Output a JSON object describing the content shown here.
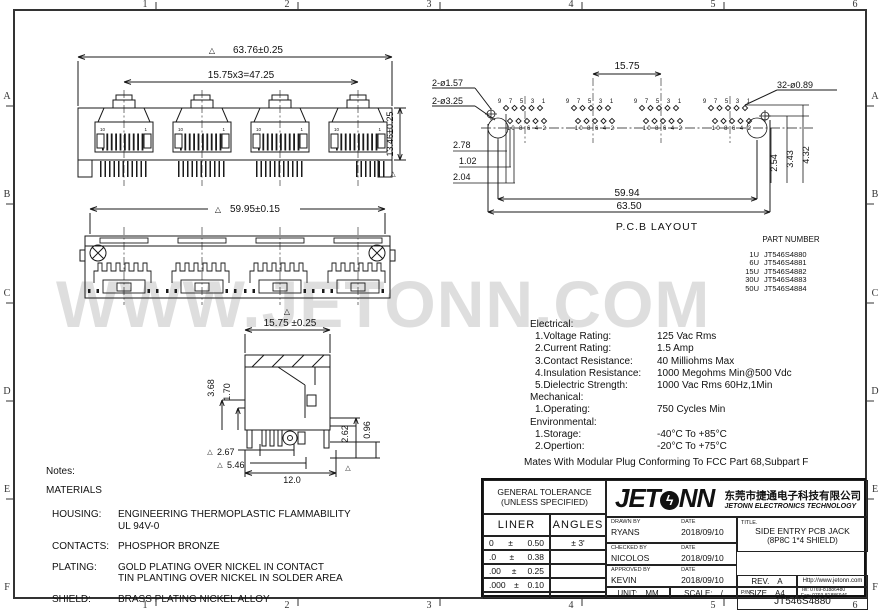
{
  "sheet": {
    "zone_cols": [
      "1",
      "2",
      "3",
      "4",
      "5",
      "6"
    ],
    "zone_rows": [
      "A",
      "B",
      "C",
      "D",
      "E",
      "F"
    ],
    "watermark": "WWW.JETONN.COM"
  },
  "icons": {
    "inspection_triangle": "△"
  },
  "views": {
    "front": {
      "dim_width": "63.76±0.25",
      "dim_pitch": "15.75x3=47.25",
      "dim_height": "13.46±0.25",
      "port_pin_left": "10",
      "port_pin_right": "1"
    },
    "rear": {
      "dim_width": "59.95±0.15"
    },
    "side": {
      "dim_width": "15.75 ±0.25",
      "dim_a": "3.68",
      "dim_b": "1.70",
      "dim_c": "2.67",
      "dim_d": "5.46",
      "dim_e": "12.0",
      "dim_f": "2.62",
      "dim_g": "0.96"
    },
    "pcb": {
      "label": "P.C.B LAYOUT",
      "dim_pitch": "15.75",
      "dim_hole_small": "2-ø1.57",
      "dim_hole_large": "2-ø3.25",
      "dim_pins": "32-ø0.89",
      "dim_a": "2.78",
      "dim_b": "1.02",
      "dim_c": "2.04",
      "dim_d": "2.54",
      "dim_e": "3.43",
      "dim_f": "4.32",
      "dim_span_inner": "59.94",
      "dim_span_outer": "63.50",
      "pin_numbers_top": "9 7 5 3 1",
      "pin_numbers_bottom": "10 8 6 4 2"
    }
  },
  "part_number": {
    "title": "PART NUMBER",
    "rows": [
      {
        "variant": "1U",
        "pn": "JT546S4880"
      },
      {
        "variant": "6U",
        "pn": "JT546S4881"
      },
      {
        "variant": "15U",
        "pn": "JT546S4882"
      },
      {
        "variant": "30U",
        "pn": "JT546S4883"
      },
      {
        "variant": "50U",
        "pn": "JT546S4884"
      }
    ]
  },
  "specs": {
    "sections": [
      {
        "header": "Electrical:",
        "items": [
          {
            "label": "1.Voltage Rating:",
            "value": "125 Vac Rms"
          },
          {
            "label": "2.Current Rating:",
            "value": "1.5 Amp"
          },
          {
            "label": "3.Contact Resistance:",
            "value": "40 Milliohms Max"
          },
          {
            "label": "4.Insulation Resistance:",
            "value": "1000 Megohms Min@500 Vdc"
          },
          {
            "label": "5.Dielectric Strength:",
            "value": "1000 Vac Rms 60Hz,1Min"
          }
        ]
      },
      {
        "header": "Mechanical:",
        "items": [
          {
            "label": "1.Operating:",
            "value": "750 Cycles Min"
          }
        ]
      },
      {
        "header": "Environmental:",
        "items": [
          {
            "label": "1.Storage:",
            "value": "-40°C To +85°C"
          },
          {
            "label": "2.Opertion:",
            "value": "-20°C To +75°C"
          }
        ]
      }
    ],
    "footer": "Mates With Modular Plug Conforming To FCC Part 68,Subpart F"
  },
  "notes": {
    "title": "Notes:",
    "materials": "MATERIALS",
    "rows": [
      {
        "label": "HOUSING:",
        "line1": "ENGINEERING THERMOPLASTIC FLAMMABILITY",
        "line2": "UL 94V-0"
      },
      {
        "label": "CONTACTS:",
        "line1": "PHOSPHOR BRONZE",
        "line2": ""
      },
      {
        "label": "PLATING:",
        "line1": "GOLD PLATING OVER NICKEL IN CONTACT",
        "line2": "TIN PLANTING OVER NICKEL IN SOLDER AREA"
      },
      {
        "label": "SHIELD:",
        "line1": "BRASS PLATING NICKEL ALLOY",
        "line2": ""
      }
    ]
  },
  "title_block": {
    "tolerance": {
      "title_line1": "GENERAL TOLERANCE",
      "title_line2": "(UNLESS SPECIFIED)",
      "col_linear": "LINER",
      "col_angles": "ANGLES",
      "rows": [
        {
          "range": "0",
          "pm": "±",
          "value": "0.50",
          "angle": "± 3'"
        },
        {
          "range": ".0",
          "pm": "±",
          "value": "0.38",
          "angle": ""
        },
        {
          "range": ".00",
          "pm": "±",
          "value": "0.25",
          "angle": ""
        },
        {
          "range": ".000",
          "pm": "±",
          "value": "0.10",
          "angle": ""
        }
      ]
    },
    "logo_text_left": "JET",
    "logo_o": "ϟ",
    "logo_text_right": "NN",
    "company_cn": "东莞市捷通电子科技有限公司",
    "company_en": "JETONN ELECTRONICS TECHNOLOGY",
    "drawn_label": "DRAWN BY",
    "drawn_name": "RYANS",
    "drawn_date_label": "DATE",
    "drawn_date": "2018/09/10",
    "checked_label": "CHECKED BY",
    "checked_name": "NICOLOS",
    "checked_date_label": "DATE",
    "checked_date": "2018/09/10",
    "approved_label": "APPROVED BY",
    "approved_name": "KEVIN",
    "approved_date_label": "DATE",
    "approved_date": "2018/09/10",
    "unit_label": "UNIT:",
    "unit_value": "MM",
    "scale_label": "SCALE:",
    "scale_value": "/",
    "title_label": "TITLE.",
    "title_line1": "SIDE ENTRY PCB JACK",
    "title_line2": "(8P8C 1*4 SHIELD)",
    "pn_label": "P/N.",
    "pn_value": "JT546S4880",
    "rev_label": "REV.",
    "rev_value": "A",
    "size_label": "SIZE",
    "size_value": "A4",
    "website": "Http://www.jetonn.com",
    "tel": "Tel:  0769-81886480",
    "fax": "Fax:  0769-81886946"
  }
}
